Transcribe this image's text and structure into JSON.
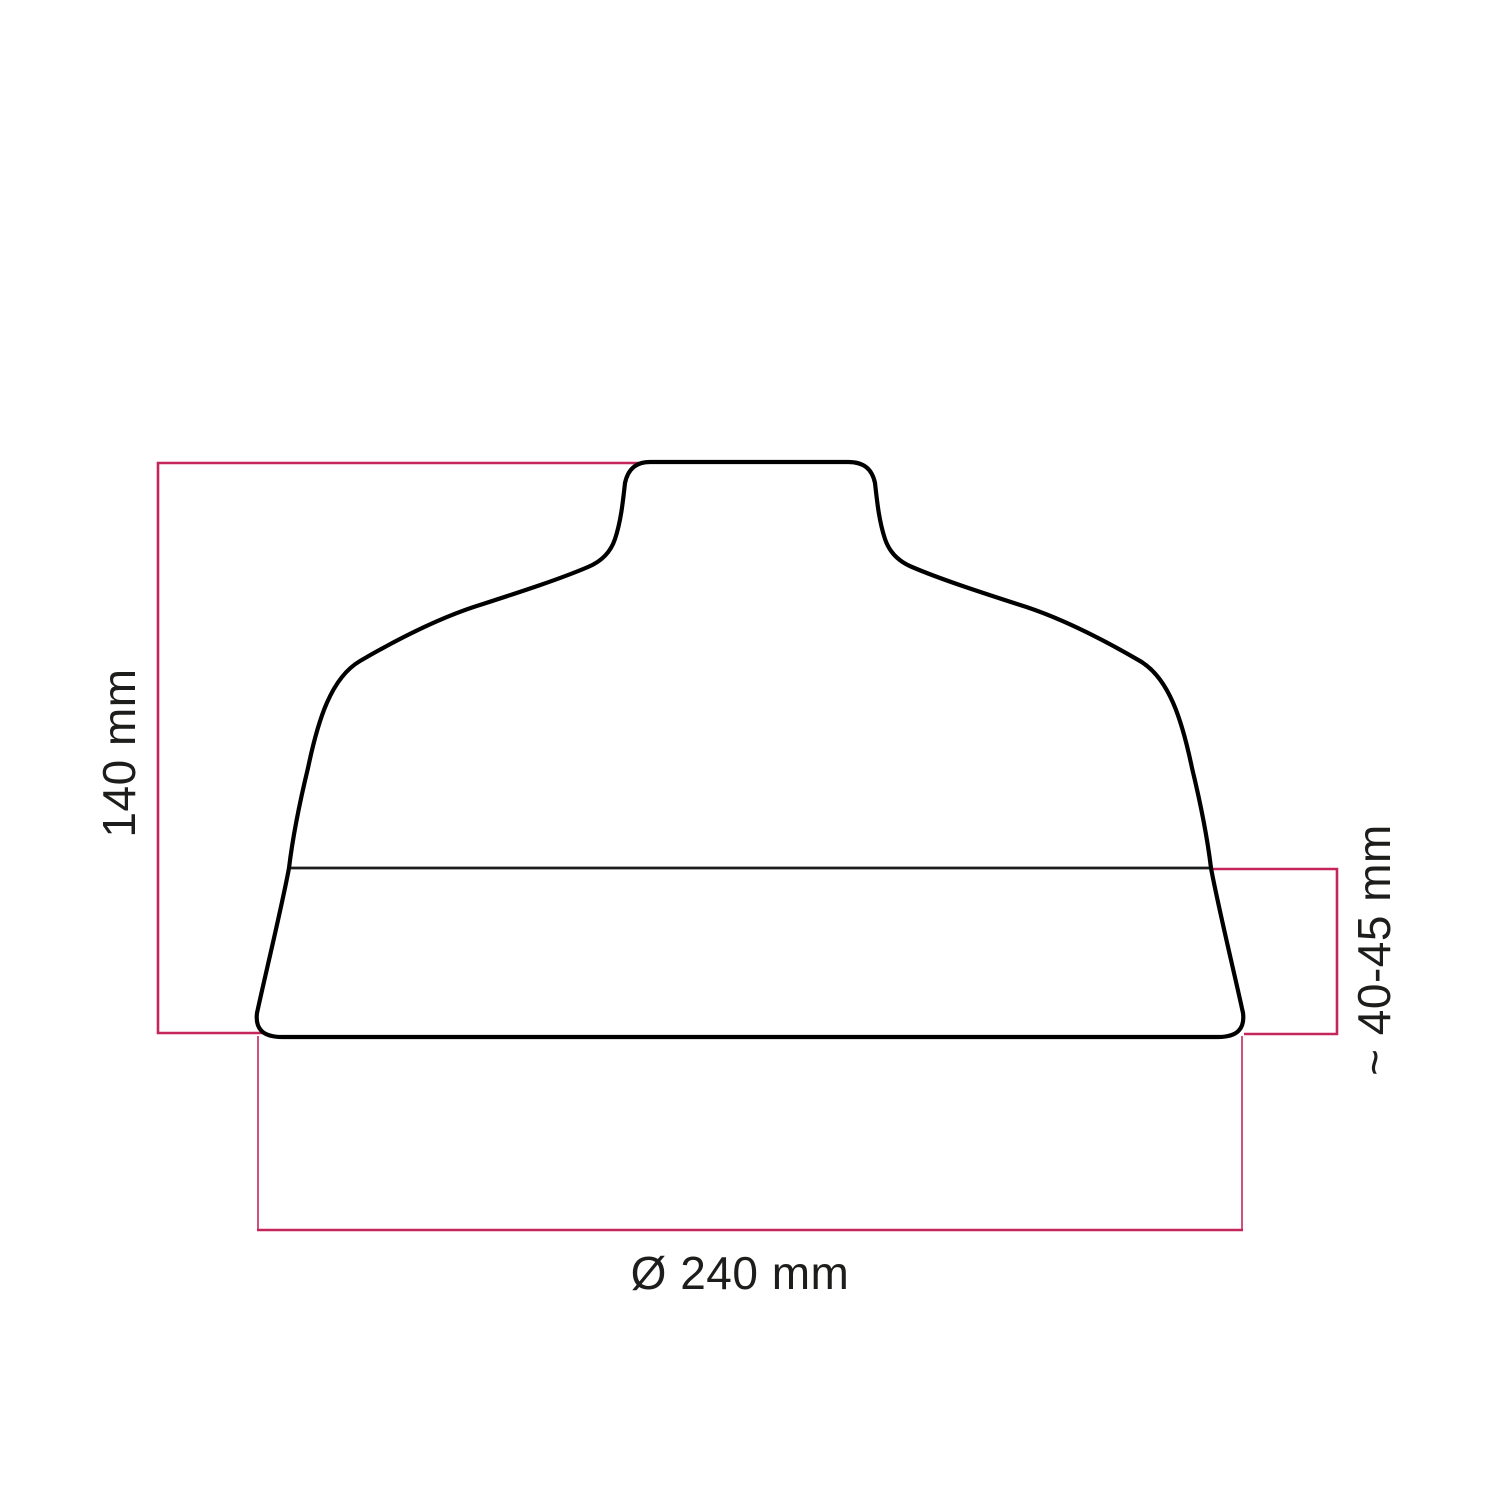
{
  "page": {
    "background": "#ffffff"
  },
  "colors": {
    "outline": "#000000",
    "band_line": "#1c1c1c",
    "accent": "#c4265a",
    "text": "#1d1d1b"
  },
  "diagram": {
    "type": "technical dimension drawing",
    "subject": "bell-shaped lampshade profile, side view",
    "dimensions": {
      "height": {
        "label": "140 mm"
      },
      "base_band": {
        "label": "~ 40-45 mm"
      },
      "diameter": {
        "label": "Ø 240 mm"
      }
    }
  }
}
